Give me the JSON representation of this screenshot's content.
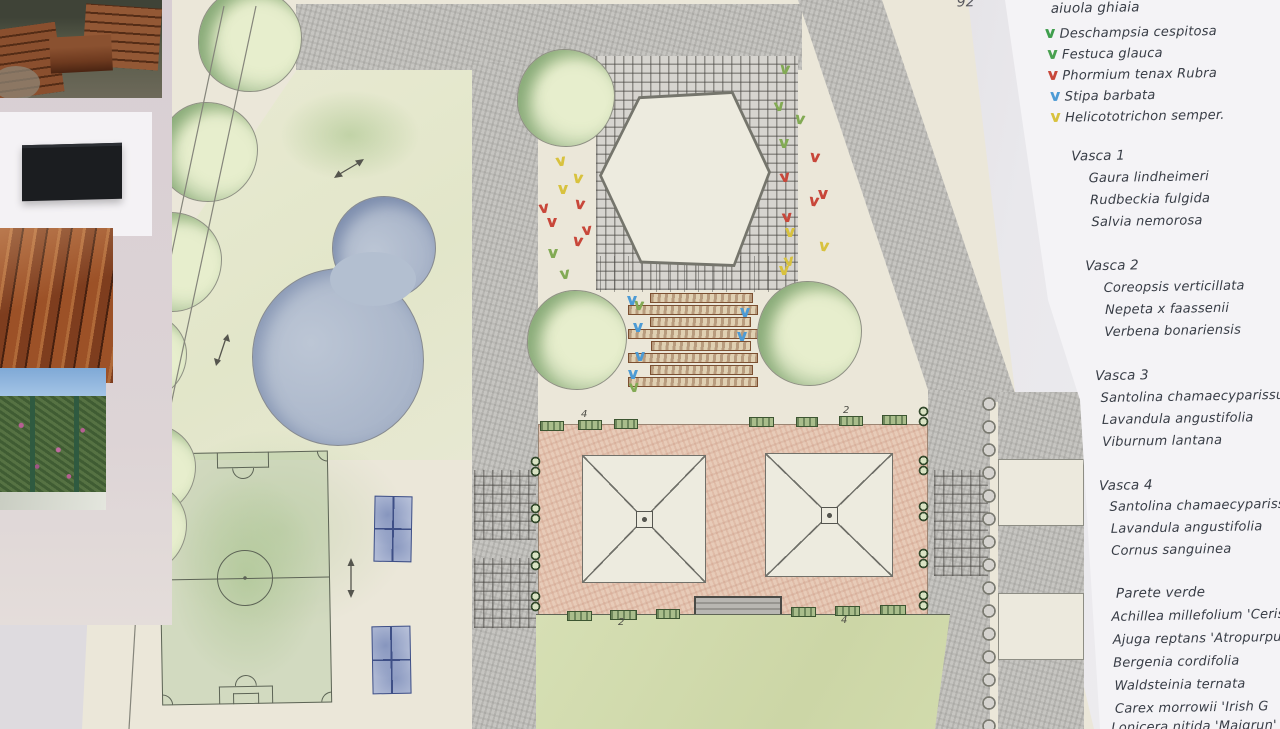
{
  "page": {
    "handwritten_page_number": "92"
  },
  "reference_photos": [
    {
      "name": "pallet-furniture",
      "label": "pallet garden furniture"
    },
    {
      "name": "black-planter",
      "label": "black rectangular planter"
    },
    {
      "name": "wood-decking",
      "label": "wood decking"
    },
    {
      "name": "green-wall",
      "label": "flowering green wall"
    }
  ],
  "colors": {
    "plan_paper": "#ebe7d9",
    "paving": "#c6c5c1",
    "terrace": "#e7cbb8",
    "lawn": "#d2dbae",
    "pond": "#aab6cb",
    "ink": "#383d46",
    "v_green": "#3f9e4d",
    "v_red": "#c8473a",
    "v_blue": "#4d9bd5",
    "v_yellow": "#d8c23e"
  },
  "plan": {
    "numbers": [
      {
        "text": "4",
        "x": 581,
        "y": 409
      },
      {
        "text": "2",
        "x": 843,
        "y": 405
      },
      {
        "text": "2",
        "x": 618,
        "y": 617
      },
      {
        "text": "4",
        "x": 841,
        "y": 615
      }
    ],
    "trees": [
      {
        "x": 198,
        "y": -12,
        "w": 104,
        "h": 104
      },
      {
        "x": 158,
        "y": 102,
        "w": 100,
        "h": 100
      },
      {
        "x": 122,
        "y": 212,
        "w": 100,
        "h": 100
      },
      {
        "x": 99,
        "y": 312,
        "w": 88,
        "h": 88
      },
      {
        "x": 104,
        "y": 423,
        "w": 92,
        "h": 92
      },
      {
        "x": 93,
        "y": 480,
        "w": 94,
        "h": 94
      },
      {
        "x": 517,
        "y": 49,
        "w": 98,
        "h": 98
      },
      {
        "x": 527,
        "y": 290,
        "w": 100,
        "h": 100
      },
      {
        "x": 757,
        "y": 281,
        "w": 105,
        "h": 105
      }
    ],
    "planters": [
      {
        "x": 540,
        "y": 421,
        "w": 24,
        "h": 10
      },
      {
        "x": 578,
        "y": 420,
        "w": 24,
        "h": 10
      },
      {
        "x": 614,
        "y": 419,
        "w": 24,
        "h": 10
      },
      {
        "x": 749,
        "y": 417,
        "w": 25,
        "h": 10
      },
      {
        "x": 796,
        "y": 417,
        "w": 22,
        "h": 10
      },
      {
        "x": 839,
        "y": 416,
        "w": 24,
        "h": 10
      },
      {
        "x": 882,
        "y": 415,
        "w": 25,
        "h": 10
      },
      {
        "x": 567,
        "y": 611,
        "w": 25,
        "h": 10
      },
      {
        "x": 610,
        "y": 610,
        "w": 27,
        "h": 10
      },
      {
        "x": 656,
        "y": 609,
        "w": 24,
        "h": 10
      },
      {
        "x": 791,
        "y": 607,
        "w": 25,
        "h": 10
      },
      {
        "x": 835,
        "y": 606,
        "w": 25,
        "h": 10
      },
      {
        "x": 880,
        "y": 605,
        "w": 26,
        "h": 10
      }
    ],
    "pot_pairs": [
      {
        "x": 530,
        "y": 456
      },
      {
        "x": 530,
        "y": 503
      },
      {
        "x": 530,
        "y": 550
      },
      {
        "x": 530,
        "y": 591
      },
      {
        "x": 918,
        "y": 406
      },
      {
        "x": 918,
        "y": 455
      },
      {
        "x": 918,
        "y": 501
      },
      {
        "x": 918,
        "y": 548
      },
      {
        "x": 918,
        "y": 590
      }
    ],
    "v_marks": [
      {
        "x": 556,
        "y": 156,
        "color": "#d8c23e",
        "rot": -10
      },
      {
        "x": 573,
        "y": 173,
        "color": "#d8c23e",
        "rot": 8
      },
      {
        "x": 558,
        "y": 184,
        "color": "#d8c23e",
        "rot": 0
      },
      {
        "x": 539,
        "y": 203,
        "color": "#c8473a",
        "rot": -8
      },
      {
        "x": 575,
        "y": 199,
        "color": "#c8473a",
        "rot": 8
      },
      {
        "x": 547,
        "y": 217,
        "color": "#c8473a",
        "rot": 0
      },
      {
        "x": 582,
        "y": 225,
        "color": "#c8473a",
        "rot": -6
      },
      {
        "x": 573,
        "y": 236,
        "color": "#c8473a",
        "rot": 8
      },
      {
        "x": 548,
        "y": 248,
        "color": "#82aa54",
        "rot": 0
      },
      {
        "x": 560,
        "y": 269,
        "color": "#82aa54",
        "rot": -8
      },
      {
        "x": 780,
        "y": 64,
        "color": "#82aa54",
        "rot": 6
      },
      {
        "x": 774,
        "y": 101,
        "color": "#82aa54",
        "rot": -6
      },
      {
        "x": 795,
        "y": 114,
        "color": "#82aa54",
        "rot": 8
      },
      {
        "x": 779,
        "y": 138,
        "color": "#82aa54",
        "rot": 0
      },
      {
        "x": 810,
        "y": 152,
        "color": "#c8473a",
        "rot": 6
      },
      {
        "x": 780,
        "y": 172,
        "color": "#c8473a",
        "rot": -8
      },
      {
        "x": 818,
        "y": 189,
        "color": "#c8473a",
        "rot": 0
      },
      {
        "x": 809,
        "y": 196,
        "color": "#c8473a",
        "rot": 8
      },
      {
        "x": 782,
        "y": 212,
        "color": "#c8473a",
        "rot": -5
      },
      {
        "x": 785,
        "y": 227,
        "color": "#d8c23e",
        "rot": 0
      },
      {
        "x": 819,
        "y": 241,
        "color": "#d8c23e",
        "rot": 8
      },
      {
        "x": 784,
        "y": 256,
        "color": "#d8c23e",
        "rot": -8
      },
      {
        "x": 779,
        "y": 265,
        "color": "#d8c23e",
        "rot": 0
      },
      {
        "x": 627,
        "y": 295,
        "color": "#4d9bd5",
        "rot": 0
      },
      {
        "x": 633,
        "y": 322,
        "color": "#4d9bd5",
        "rot": 0
      },
      {
        "x": 635,
        "y": 351,
        "color": "#4d9bd5",
        "rot": 0
      },
      {
        "x": 628,
        "y": 369,
        "color": "#4d9bd5",
        "rot": 0
      },
      {
        "x": 740,
        "y": 307,
        "color": "#4d9bd5",
        "rot": 0
      },
      {
        "x": 737,
        "y": 331,
        "color": "#4d9bd5",
        "rot": 0
      },
      {
        "x": 634,
        "y": 300,
        "color": "#82aa54",
        "rot": 6
      },
      {
        "x": 629,
        "y": 382,
        "color": "#82aa54",
        "rot": -6
      }
    ]
  },
  "notes": {
    "gravel_bed": {
      "title": "aiuola ghiaia",
      "items": [
        {
          "icon": "plant-v-green",
          "color": "#3f9e4d",
          "text": "Deschampsia cespitosa"
        },
        {
          "icon": "plant-v-green",
          "color": "#49a050",
          "text": "Festuca glauca"
        },
        {
          "icon": "plant-v-red",
          "color": "#c8473a",
          "text": "Phormium tenax Rubra"
        },
        {
          "icon": "plant-v-blue",
          "color": "#4d9bd5",
          "text": "Stipa barbata"
        },
        {
          "icon": "plant-v-yellow",
          "color": "#d8c23e",
          "text": "Helicototrichon semper."
        }
      ]
    },
    "sections": [
      {
        "title": "Vasca 1",
        "items": [
          "Gaura lindheimeri",
          "Rudbeckia fulgida",
          "Salvia nemorosa"
        ]
      },
      {
        "title": "Vasca 2",
        "items": [
          "Coreopsis verticillata",
          "Nepeta x faassenii",
          "Verbena bonariensis"
        ]
      },
      {
        "title": "Vasca 3",
        "items": [
          "Santolina chamaecyparissus",
          "Lavandula angustifolia",
          "Viburnum lantana"
        ]
      },
      {
        "title": "Vasca 4",
        "items": [
          "Santolina chamaecyparissus",
          "Lavandula angustifolia",
          "Cornus sanguinea"
        ]
      },
      {
        "title": "Parete verde",
        "items": [
          "Achillea millefolium 'Cerise Qu",
          "Ajuga reptans 'Atropurpurea'",
          "Bergenia cordifolia",
          "Waldsteinia ternata",
          "Carex morrowii 'Irish G",
          "Lonicera nitida 'Maigrun'"
        ]
      }
    ]
  }
}
